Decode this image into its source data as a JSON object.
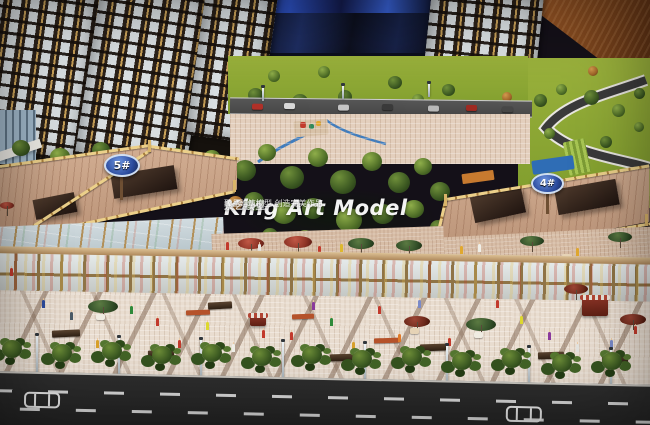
{
  "scene": {
    "description": "Photograph of an architectural scale model (real-estate sales model) showing residential towers over a retail podium, landscaped garden, pedestrian street and road",
    "watermark": {
      "title": "King Art Model",
      "subtitle": "景艺模型",
      "tagline": "臻品建筑模型 创造完美作品"
    },
    "signs": {
      "building_5": "5#",
      "building_4": "4#"
    },
    "palette": {
      "tower_facade": "#3a3029",
      "tower_window": "#dde3e6",
      "gold_trim": "#c9a158",
      "backdrop": "#0d1020",
      "backdrop_streak": "#2f55cc",
      "brown_wall": "#82491f",
      "lawn": "#8ea832",
      "tree_green": "#3f5c23",
      "plaza_tile": "#e3cfbd",
      "podium_deck": "#c89f82",
      "storefront_glass": "#d4dcdc",
      "sidewalk": "#e9ddd0",
      "asphalt": "#282828",
      "road_marking": "#e8e8e8",
      "sign_blue": "#2a4a9c",
      "umbrella_red": "#8e3426",
      "umbrella_green": "#34512a"
    }
  }
}
